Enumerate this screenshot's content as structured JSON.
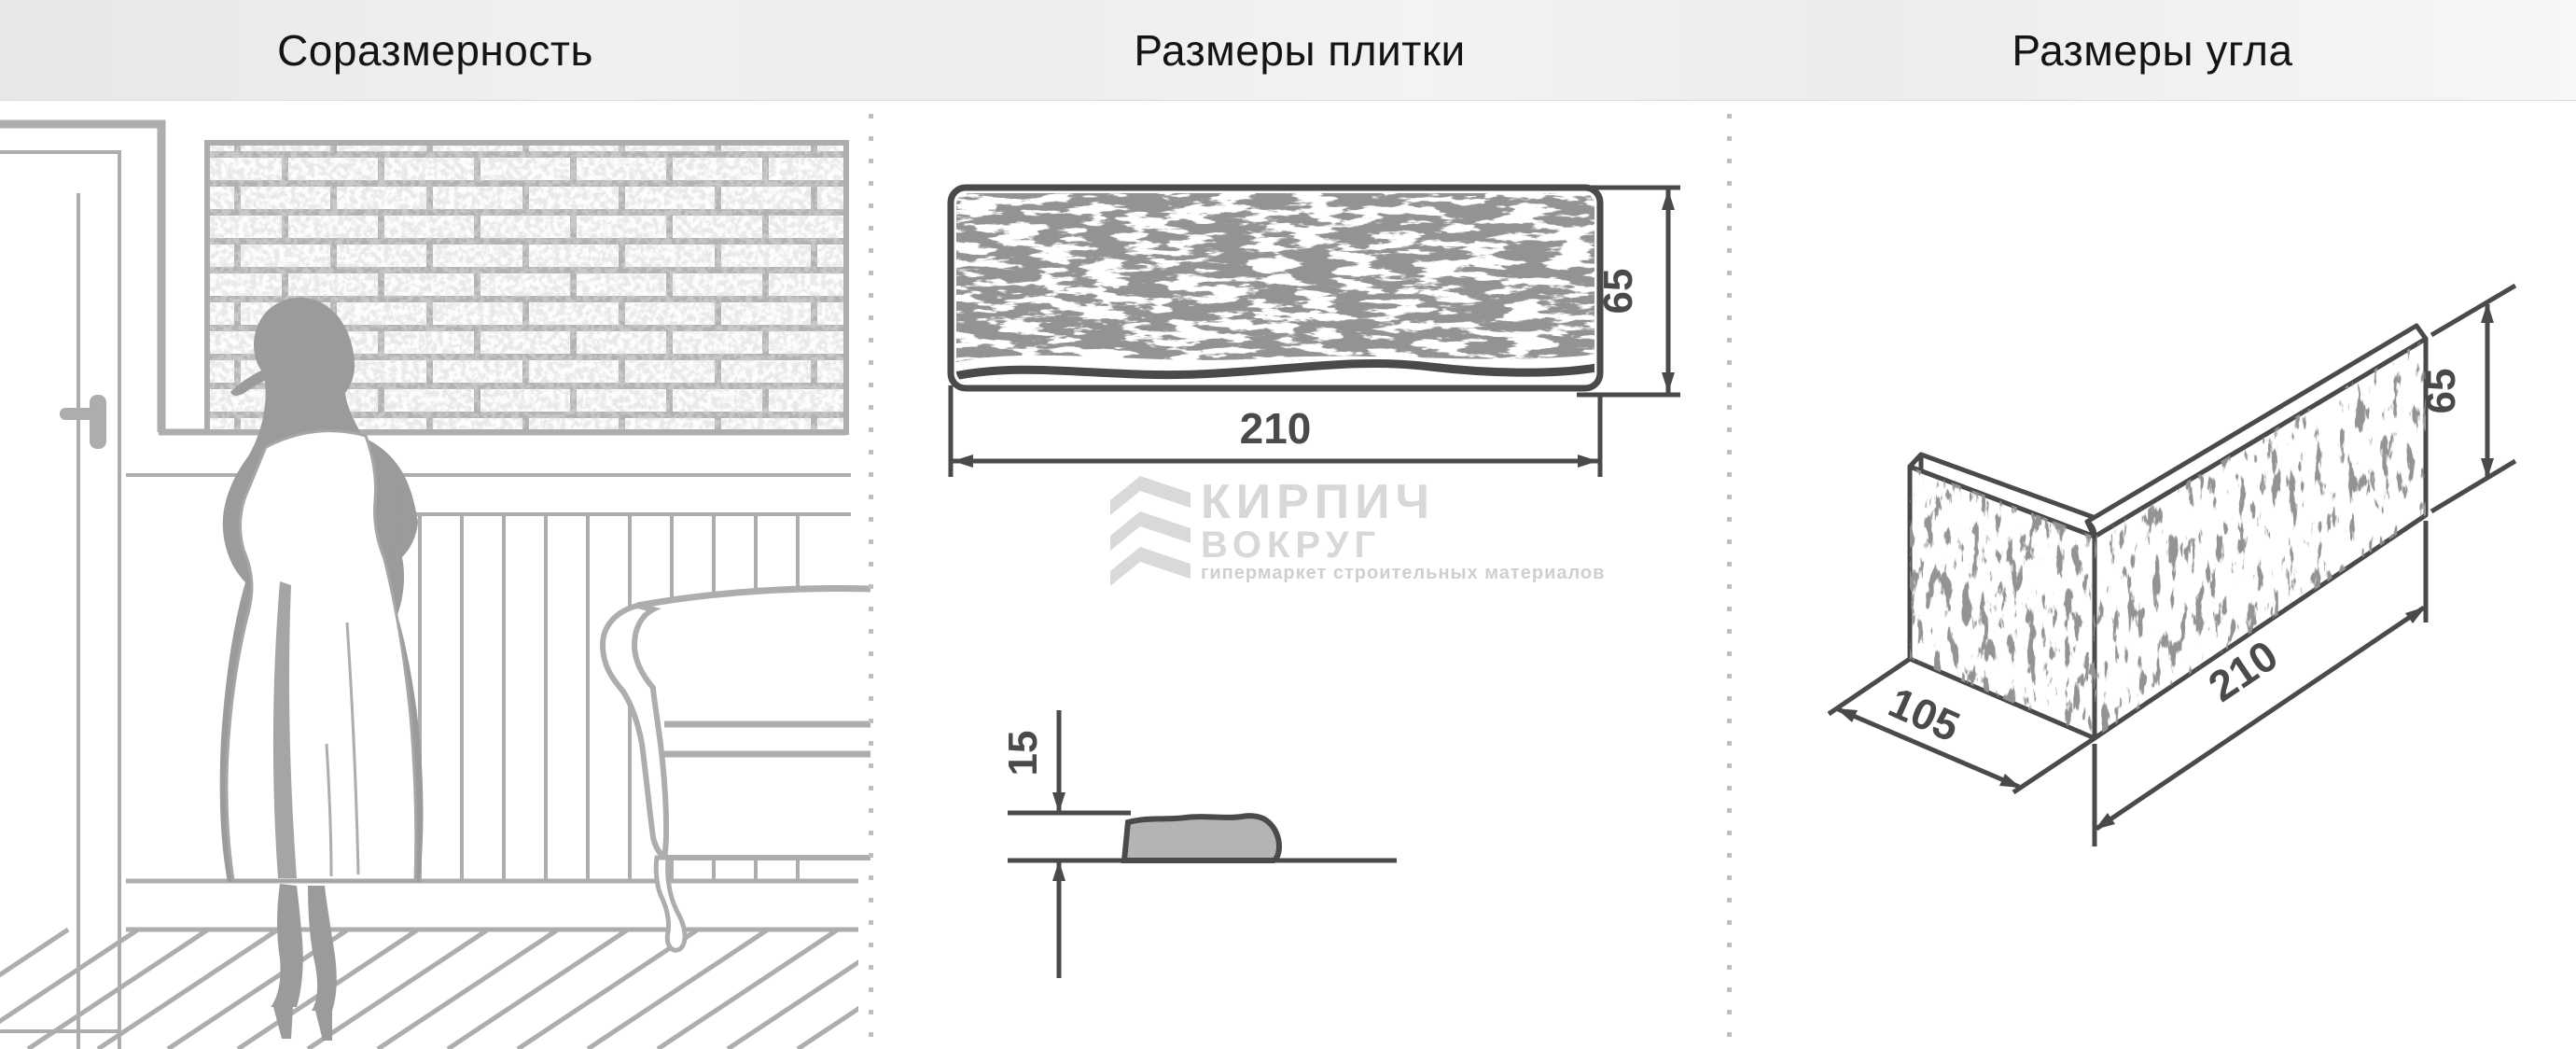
{
  "header": {
    "left_title": "Соразмерность",
    "middle_title": "Размеры плитки",
    "right_title": "Размеры угла"
  },
  "tile_front": {
    "width_label": "210",
    "height_label": "65"
  },
  "tile_profile": {
    "thickness_label": "15"
  },
  "corner_piece": {
    "depth_label": "105",
    "width_label": "210",
    "height_label": "65"
  },
  "logo": {
    "title": "КИРПИЧ",
    "subtitle": "ВОКРУГ",
    "caption": "гипермаркет строительных материалов"
  },
  "colors": {
    "drawing_dark": "#4a4a4a",
    "lineart_gray": "#adadad",
    "silhouette_gray": "#9b9b9b",
    "profile_fill": "#b4b4b4",
    "watermark_gray": "#d8d8d8",
    "mortar_gray": "#b2b2b2",
    "separator_dot": "#bdbdbd",
    "header_text": "#141414"
  }
}
